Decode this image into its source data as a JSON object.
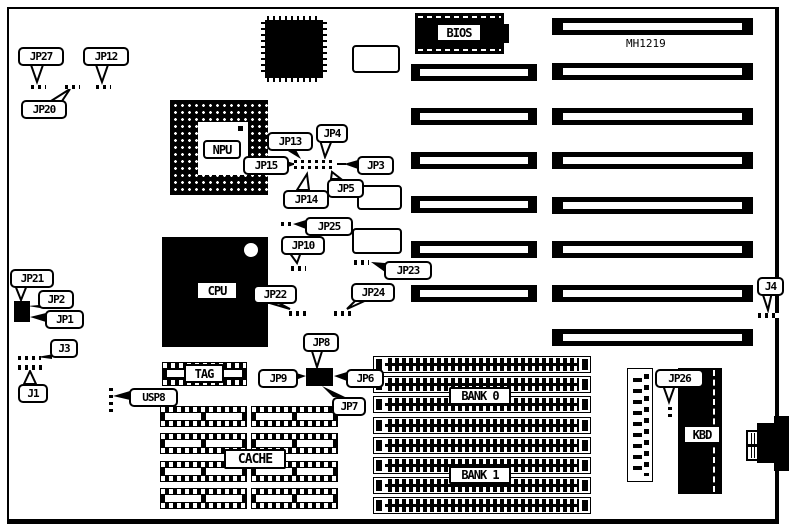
{
  "board": {
    "model": "MH1219"
  },
  "chips": {
    "bios": "BIOS",
    "npu": "NPU",
    "cpu": "CPU",
    "tag": "TAG",
    "cache": "CACHE",
    "bank0": "BANK 0",
    "bank1": "BANK 1",
    "kbd": "KBD"
  },
  "callouts": {
    "jp27": "JP27",
    "jp12": "JP12",
    "jp20": "JP20",
    "jp13": "JP13",
    "jp4": "JP4",
    "jp15": "JP15",
    "jp3": "JP3",
    "jp5": "JP5",
    "jp14": "JP14",
    "jp25": "JP25",
    "jp10": "JP10",
    "jp23": "JP23",
    "jp22": "JP22",
    "jp24": "JP24",
    "jp8": "JP8",
    "jp9": "JP9",
    "jp6": "JP6",
    "jp7": "JP7",
    "jp21": "JP21",
    "jp2": "JP2",
    "jp1": "JP1",
    "j3": "J3",
    "j1": "J1",
    "usp8": "USP8",
    "j4": "J4",
    "jp26": "JP26"
  },
  "colors": {
    "ink": "#000000",
    "paper": "#ffffff"
  }
}
